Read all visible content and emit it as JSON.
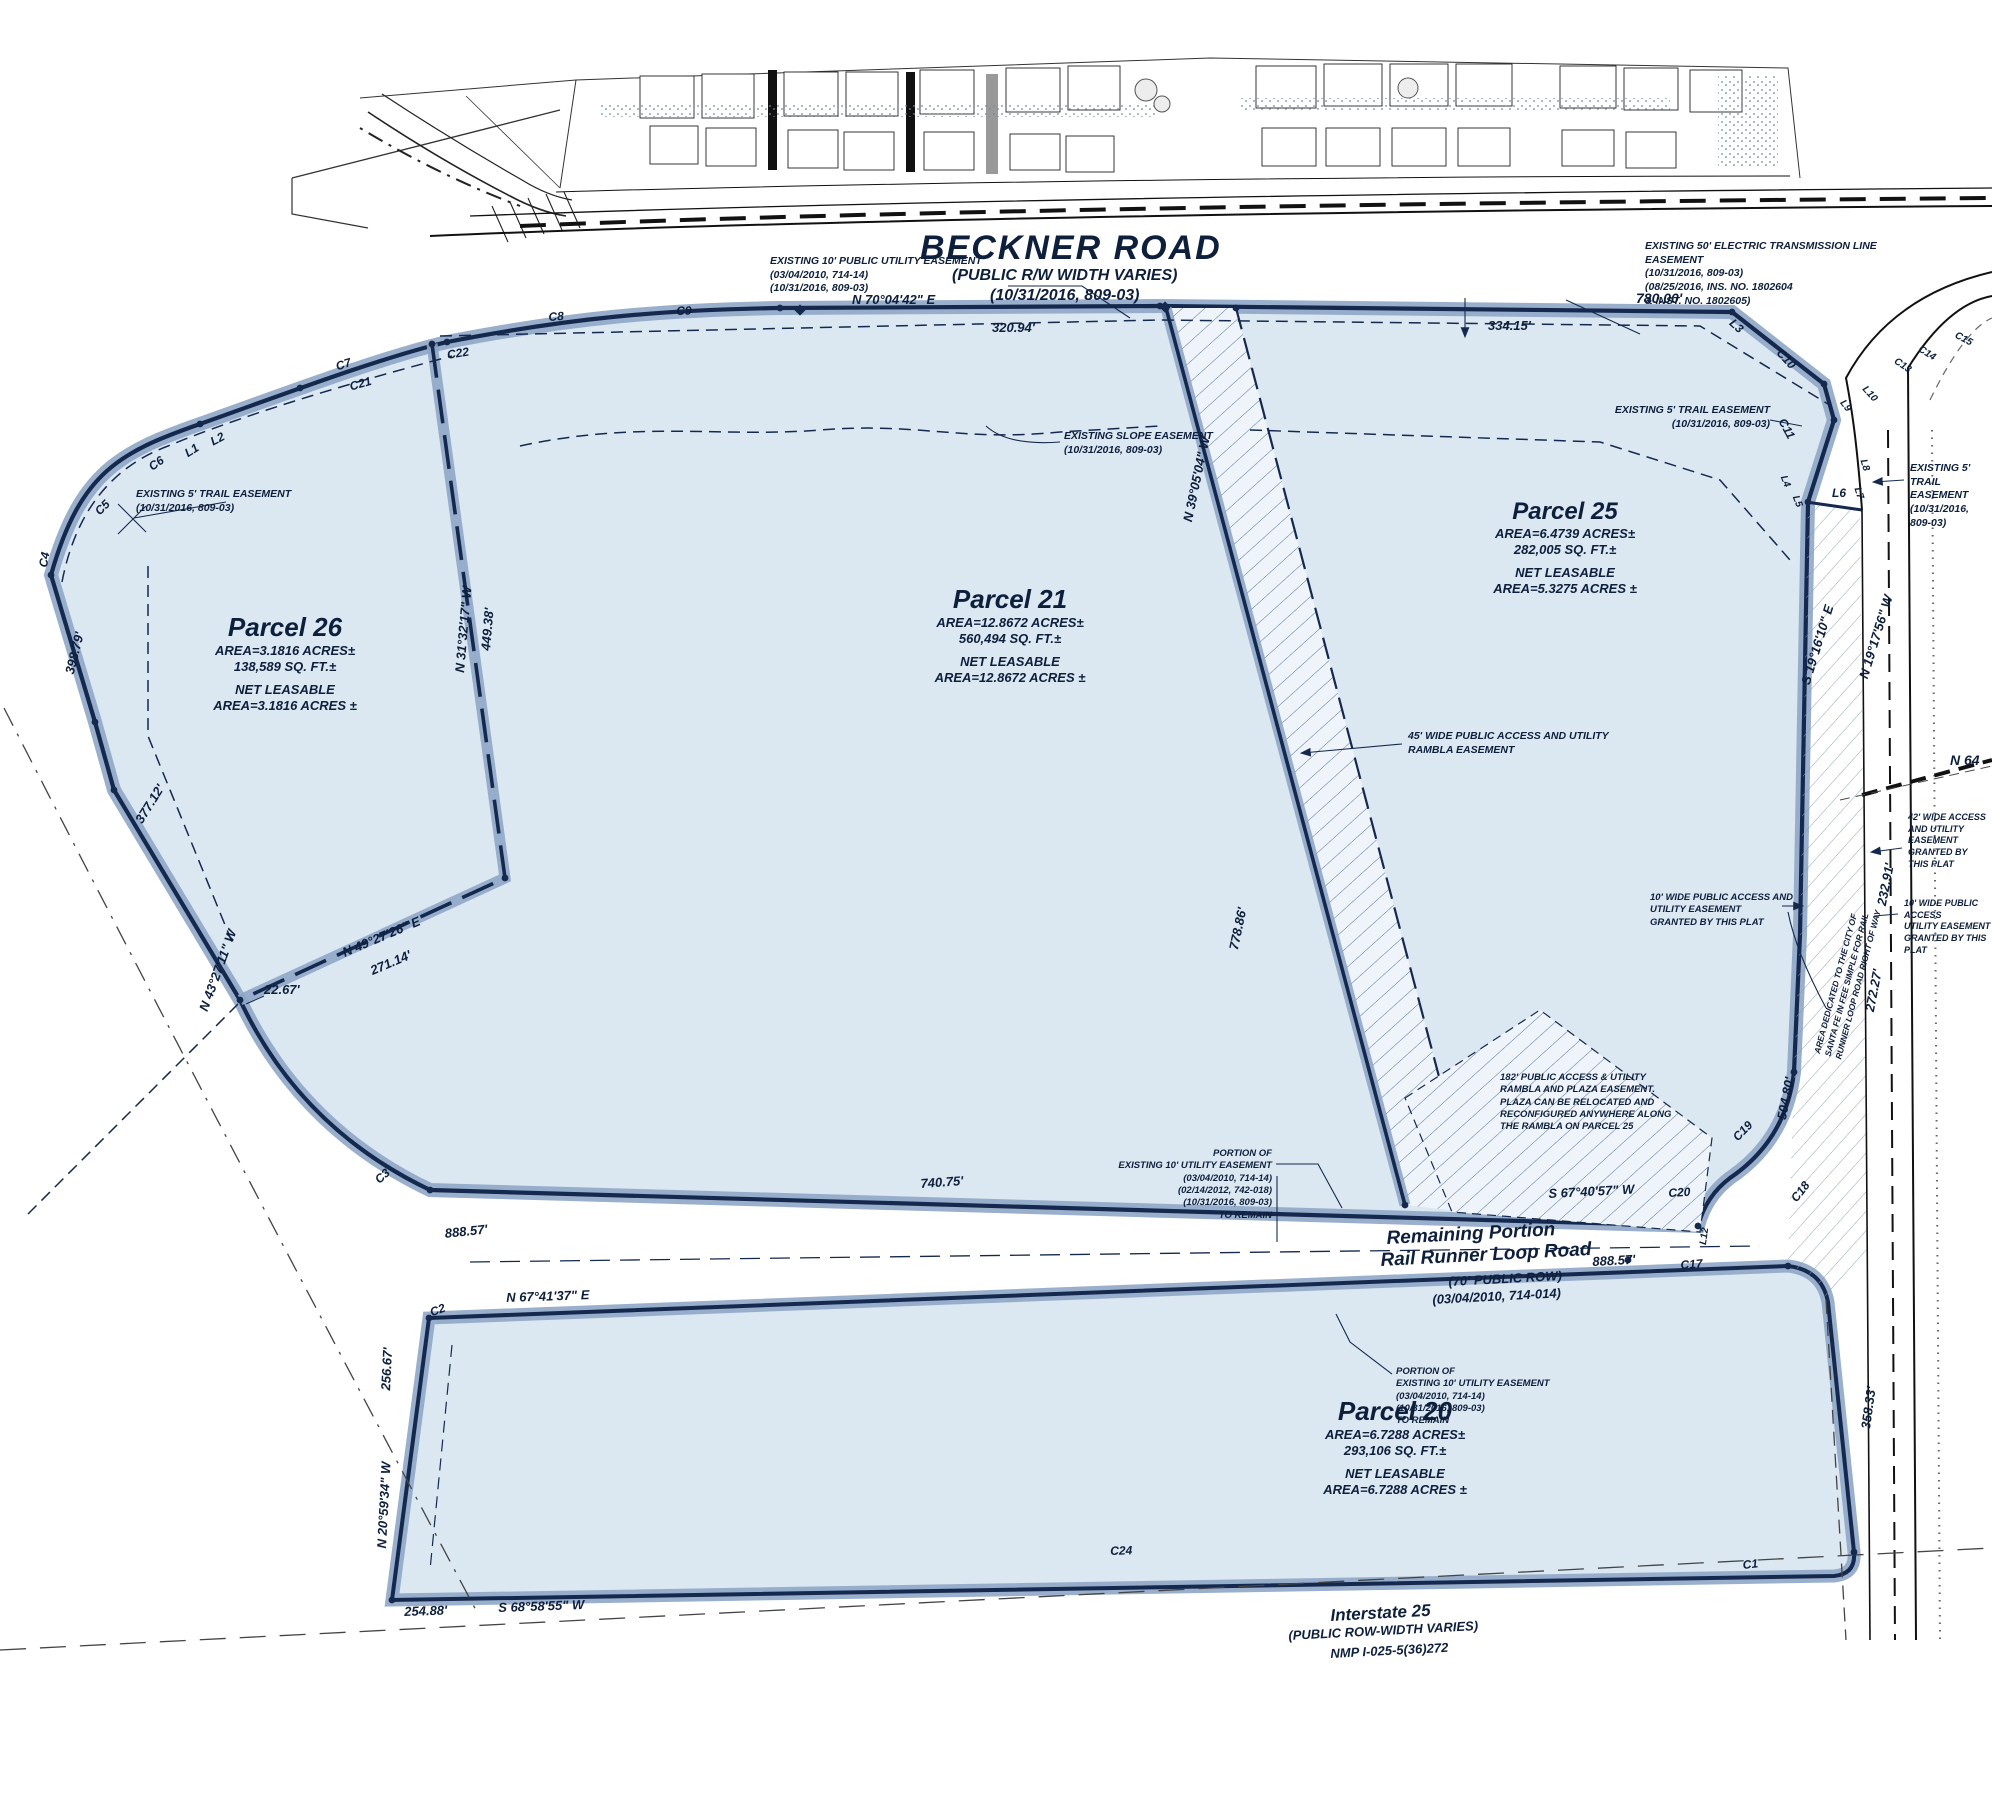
{
  "colors": {
    "parcel_fill": "#dbe7f1",
    "boundary_band": "#8ea6c6",
    "line_dark": "#15294e",
    "hatch": "#5b7490"
  },
  "roads": {
    "beckner": {
      "title": "BECKNER ROAD",
      "sub1": "(PUBLIC R/W WIDTH VARIES)",
      "sub2": "(10/31/2016, 809-03)"
    },
    "rail_runner": {
      "l1": "Remaining Portion",
      "l2": "Rail Runner Loop Road",
      "l3": "(70' PUBLIC ROW)",
      "l4": "(03/04/2010, 714-014)"
    },
    "interstate": {
      "l1": "Interstate 25",
      "l2": "(PUBLIC ROW-WIDTH VARIES)",
      "l3": "NMP I-025-5(36)272"
    }
  },
  "parcels": {
    "p26": {
      "name": "Parcel 26",
      "area": "AREA=3.1816 ACRES±",
      "sqft": "138,589 SQ. FT.±",
      "net1": "NET LEASABLE",
      "net2": "AREA=3.1816 ACRES ±"
    },
    "p21": {
      "name": "Parcel 21",
      "area": "AREA=12.8672 ACRES±",
      "sqft": "560,494 SQ. FT.±",
      "net1": "NET LEASABLE",
      "net2": "AREA=12.8672 ACRES ±"
    },
    "p25": {
      "name": "Parcel 25",
      "area": "AREA=6.4739 ACRES±",
      "sqft": "282,005 SQ. FT.±",
      "net1": "NET LEASABLE",
      "net2": "AREA=5.3275 ACRES ±"
    },
    "p20": {
      "name": "Parcel 20",
      "area": "AREA=6.7288 ACRES±",
      "sqft": "293,106 SQ. FT.±",
      "net1": "NET LEASABLE",
      "net2": "AREA=6.7288 ACRES ±"
    }
  },
  "notes": {
    "top_utility": [
      "EXISTING 10' PUBLIC UTILITY EASEMENT",
      "(03/04/2010, 714-14)",
      "(10/31/2016, 809-03)"
    ],
    "transmission": [
      "EXISTING 50' ELECTRIC TRANSMISSION LINE",
      "EASEMENT",
      "(10/31/2016, 809-03)",
      "(08/25/2016, INS. NO. 1802604",
      "& INST. NO. 1802605)"
    ],
    "slope": [
      "EXISTING SLOPE EASEMENT",
      "(10/31/2016, 809-03)"
    ],
    "trail_left": [
      "EXISTING 5' TRAIL EASEMENT",
      "(10/31/2016, 809-03)"
    ],
    "trail_right_top": [
      "EXISTING 5' TRAIL EASEMENT",
      "(10/31/2016, 809-03)"
    ],
    "trail_right_side": [
      "EXISTING 5'",
      "TRAIL",
      "EASEMENT",
      "(10/31/2016,",
      "809-03)"
    ],
    "rambla45": [
      "45' WIDE PUBLIC ACCESS AND UTILITY",
      "RAMBLA EASEMENT"
    ],
    "access10a": [
      "10' WIDE PUBLIC ACCESS AND",
      "UTILITY EASEMENT",
      "GRANTED BY THIS PLAT"
    ],
    "access42": [
      "42' WIDE ACCESS",
      "AND UTILITY",
      "EASEMENT",
      "GRANTED BY",
      "THIS PLAT"
    ],
    "access10b": [
      "10' WIDE PUBLIC ACCESS",
      "UTILITY EASEMENT",
      "GRANTED BY THIS PLAT"
    ],
    "dedicated": [
      "AREA DEDICATED TO THE CITY OF",
      "SANTA FE IN FEE SIMPLE FOR RAIL",
      "RUNNER LOOP ROAD RIGHT OF WAY"
    ],
    "plaza182": [
      "182' PUBLIC ACCESS & UTILITY",
      "RAMBLA AND PLAZA EASEMENT.",
      "PLAZA CAN BE RELOCATED AND",
      "RECONFIGURED ANYWHERE ALONG",
      "THE RAMBLA ON PARCEL 25"
    ],
    "portion_upper": [
      "PORTION OF",
      "EXISTING 10' UTILITY EASEMENT",
      "(03/04/2010, 714-14)",
      "(02/14/2012, 742-018)",
      "(10/31/2016, 809-03)",
      "TO REMAIN"
    ],
    "portion_lower": [
      "PORTION OF",
      "EXISTING 10' UTILITY EASEMENT",
      "(03/04/2010, 714-14)",
      "(10/31/2016, 809-03)",
      "TO REMAIN"
    ]
  },
  "bearings": {
    "n7004": "N 70°04'42\" E",
    "d32094": "320.94'",
    "d33415": "334.15'",
    "d78000": "780.00'",
    "n3905": "N 39°05'04\" W",
    "d77886": "778.86'",
    "s6740": "S 67°40'57\" W",
    "d88857_r": "888.57'",
    "d88857_l": "888.57'",
    "d74075": "740.75'",
    "n6741": "N 67°41'37\" E",
    "d25667": "256.67'",
    "n2059": "N 20°59'34\" W",
    "d25488": "254.88'",
    "s6858": "S 68°58'55\" W",
    "d39879": "398.79'",
    "d37712": "377.12'",
    "n4327": "N 43°27'11\" W",
    "d2267": "22.67'",
    "n4927": "N 49°27'26\" E",
    "d27114": "271.14'",
    "n3132": "N 31°32'17\" W",
    "d44938": "449.38'",
    "s1916": "S 19°16'10\" E",
    "n1917": "N 19°17'56\" W",
    "d23291": "232.91'",
    "d27227": "272.27'",
    "d50480": "504.80'",
    "d35833": "358.33'",
    "n64": "N 64"
  },
  "curves": {
    "c1": "C1",
    "c2": "C2",
    "c3": "C3",
    "c4": "C4",
    "c5": "C5",
    "c6": "C6",
    "c7": "C7",
    "c8": "C8",
    "c9": "C9",
    "c10": "C10",
    "c11": "C11",
    "c13": "C13",
    "c14": "C14",
    "c15": "C15",
    "c17": "C17",
    "c18": "C18",
    "c19": "C19",
    "c20": "C20",
    "c21": "C21",
    "c22": "C22",
    "c24": "C24",
    "l1": "L1",
    "l2": "L2",
    "l3": "L3",
    "l4": "L4",
    "l5": "L5",
    "l6": "L6",
    "l7": "L7",
    "l8": "L8",
    "l9": "L9",
    "l10": "L10",
    "l12": "L12"
  }
}
